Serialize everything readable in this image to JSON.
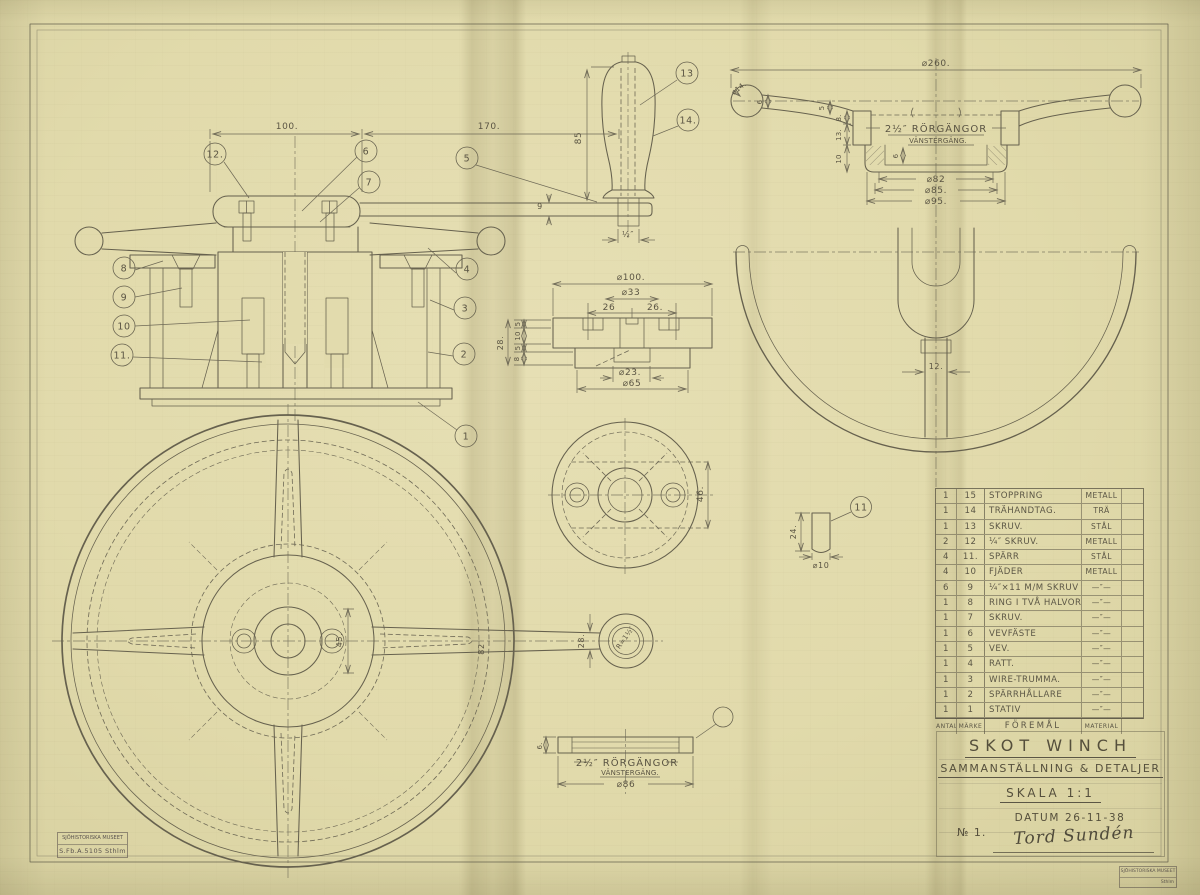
{
  "colors": {
    "paper": "#e1daab",
    "pencil": "#66614e",
    "stamp": "#605870"
  },
  "title_block": {
    "title": "SKOT WINCH",
    "subtitle": "SAMMANSTÄLLNING & DETALJER",
    "scale": "SKALA 1:1",
    "date": "DATUM 26-11-38",
    "sheet_no": "№ 1.",
    "signature": "Tord Sundén"
  },
  "stamps": {
    "left_line1": "SJÖHISTORISKA MUSEET",
    "left_line2": "S.Fb.A.5105  Sthlm",
    "right_line1": "SJÖHISTORISKA MUSEET",
    "right_line2": "Sthlm"
  },
  "parts_table": {
    "footer": {
      "qty": "ANTAL",
      "mark": "MÄRKE",
      "item": "FÖREMÅL",
      "material": "MATERIAL"
    },
    "rows": [
      {
        "qty": "1",
        "mark": "15",
        "item": "STOPPRING",
        "material": "METALL"
      },
      {
        "qty": "1",
        "mark": "14",
        "item": "TRÄHANDTAG.",
        "material": "TRÄ"
      },
      {
        "qty": "1",
        "mark": "13",
        "item": "SKRUV.",
        "material": "STÅL"
      },
      {
        "qty": "2",
        "mark": "12",
        "item": "¼″ SKRUV.",
        "material": "METALL"
      },
      {
        "qty": "4",
        "mark": "11.",
        "item": "SPÄRR",
        "material": "STÅL"
      },
      {
        "qty": "4",
        "mark": "10",
        "item": "FJÄDER",
        "material": "METALL"
      },
      {
        "qty": "6",
        "mark": "9",
        "item": "¼″×11 M/M SKRUV",
        "material": "—″—"
      },
      {
        "qty": "1",
        "mark": "8",
        "item": "RING I TVÅ HALVOR.",
        "material": "—″—"
      },
      {
        "qty": "1",
        "mark": "7",
        "item": "SKRUV.",
        "material": "—″—"
      },
      {
        "qty": "1",
        "mark": "6",
        "item": "VEVFÄSTE",
        "material": "—″—"
      },
      {
        "qty": "1",
        "mark": "5",
        "item": "VEV.",
        "material": "—″—"
      },
      {
        "qty": "1",
        "mark": "4",
        "item": "RATT.",
        "material": "—″—"
      },
      {
        "qty": "1",
        "mark": "3",
        "item": "WIRE-TRUMMA.",
        "material": "—″—"
      },
      {
        "qty": "1",
        "mark": "2",
        "item": "SPÄRRHÅLLARE",
        "material": "—″—"
      },
      {
        "qty": "1",
        "mark": "1",
        "item": "STATIV",
        "material": "—″—"
      }
    ]
  },
  "annotations": {
    "main_view": {
      "dim_100": "100.",
      "dim_170": "170.",
      "dim_9": "9",
      "balloons": [
        "12.",
        "6",
        "7",
        "5",
        "8",
        "9",
        "10",
        "11.",
        "4",
        "3",
        "2",
        "1"
      ]
    },
    "handle_view": {
      "dim_85": "85",
      "dim_half": "½″",
      "balloon_13": "13",
      "balloon_14": "14."
    },
    "wheel_section": {
      "dim_260": "⌀260.",
      "dim_14": "⌀14.",
      "dim_6": "6",
      "dim_5": "5",
      "dim_8": "8.",
      "dim_13": "13.",
      "dim_10": "10",
      "dim_6b": "6",
      "thread_line1": "2½″ RÖRGÄNGOR",
      "thread_line2": "VÄNSTERGÄNG.",
      "dim_82": "⌀82",
      "dim_85": "⌀85.",
      "dim_95": "⌀95."
    },
    "wheel_plan": {
      "dim_12": "12."
    },
    "flange_section": {
      "dim_100": "⌀100.",
      "dim_33": "⌀33",
      "dim_26l": "26",
      "dim_26r": "26.",
      "dim_23": "⌀23.",
      "dim_65": "⌀65",
      "dim_28": "28.",
      "dim_5a": "5",
      "dim_10": "10",
      "dim_5b": "5",
      "dim_8": "8"
    },
    "flange_plan": {
      "dim_46": "46."
    },
    "pawl_detail": {
      "dim_24": "24.",
      "dim_10": "⌀10",
      "balloon": "11"
    },
    "big_wheel": {
      "dim_45": "45.",
      "dim_28": "28.",
      "dim_82": "82",
      "radius_label": "R=1½″"
    },
    "ring_detail": {
      "thread_line1": "2½″ RÖRGÄNGOR",
      "thread_line2": "VÄNSTERGÄNG.",
      "dim_86": "⌀86",
      "dim_6": "6."
    }
  }
}
